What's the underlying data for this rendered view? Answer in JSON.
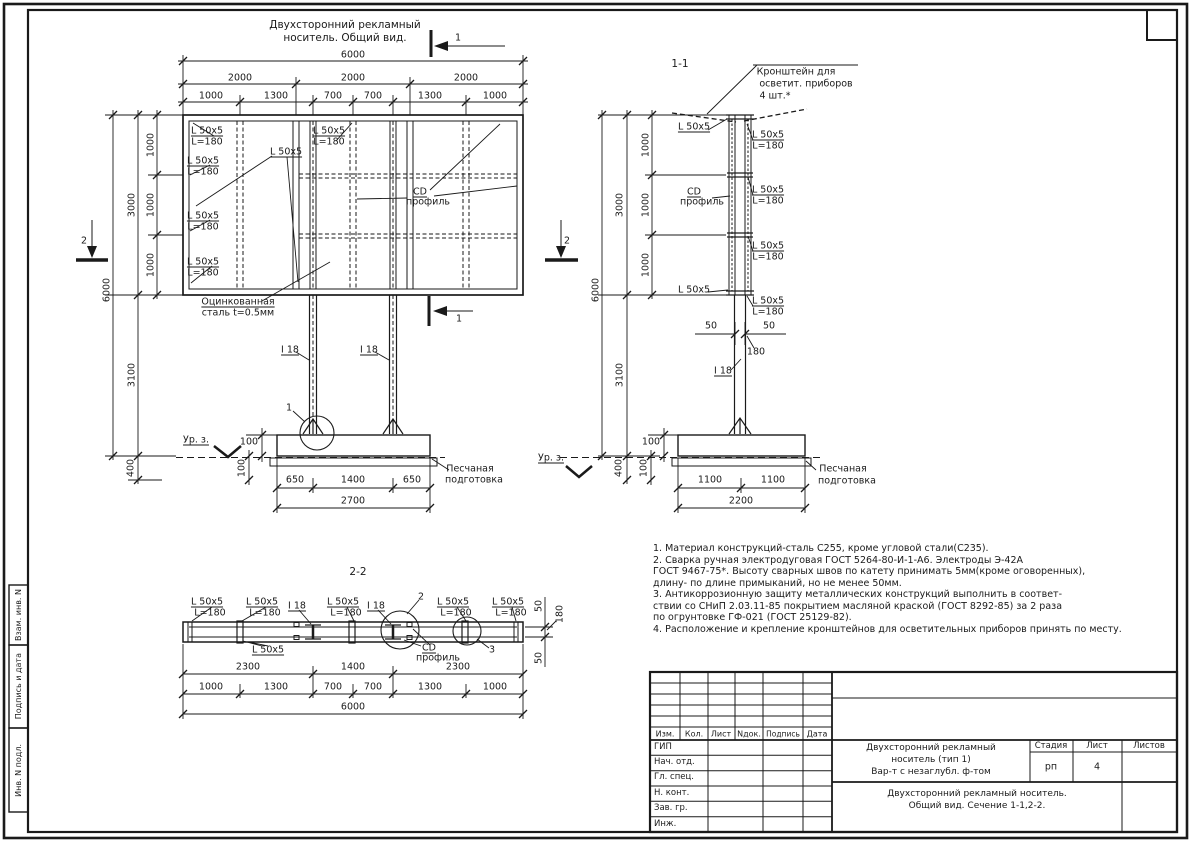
{
  "colors": {
    "line": "#1a1a1a",
    "paper": "#ffffff"
  },
  "side_strip": {
    "boxes": [
      "Взам. инв. N",
      "Подпись и дата",
      "Инв. N подл."
    ]
  },
  "notes": {
    "lines": [
      "1. Материал конструкций-сталь С255, кроме угловой стали(С235).",
      "2. Сварка ручная электродуговая ГОСТ 5264-80-И-1-А6. Электроды Э-42А",
      "ГОСТ 9467-75*. Высоту сварных швов по катету принимать 5мм(кроме оговоренных),",
      "длину- по длине примыканий, но не менее 50мм.",
      "3. Антикоррозионную защиту металлических конструкций выполнить в соответ-",
      "ствии со СНиП 2.03.11-85 покрытием масляной краской (ГОСТ 8292-85) за 2 раза",
      "по огрунтовке ГФ-021 (ГОСТ 25129-82).",
      "4. Расположение и крепление кронштейнов для осветительных приборов принять по месту."
    ]
  },
  "stamp": {
    "rev_cols": [
      "Изм.",
      "Кол.",
      "Лист",
      "Nдок.",
      "Подпись",
      "Дата"
    ],
    "roles": [
      "ГИП",
      "Нач. отд.",
      "Гл. спец.",
      "Н. конт.",
      "Зав. гр.",
      "Инж."
    ],
    "doc_title": [
      "Двухсторонний рекламный",
      "носитель (тип 1)",
      "Вар-т с незаглубл. ф-том"
    ],
    "stage_label": "Стадия",
    "sheet_label": "Лист",
    "sheets_label": "Листов",
    "stage": "рп",
    "sheet": "4",
    "sheets": "",
    "subtitle": [
      "Двухсторонний рекламный носитель.",
      "Общий вид.  Сечение 1-1,2-2."
    ]
  },
  "annotations": [
    {
      "t": "Двухсторонний рекламный",
      "x": 345,
      "y": 25,
      "fs": 10.5,
      "n": "front-view-title"
    },
    {
      "t": "носитель. Общий вид.",
      "x": 345,
      "y": 38,
      "fs": 10.5,
      "n": "front-view-title"
    },
    {
      "t": "1",
      "x": 458,
      "y": 38,
      "n": "section-mark-1-label"
    },
    {
      "t": "6000",
      "x": 353,
      "y": 55
    },
    {
      "t": "2000",
      "x": 240,
      "y": 78
    },
    {
      "t": "2000",
      "x": 353,
      "y": 78
    },
    {
      "t": "2000",
      "x": 466,
      "y": 78
    },
    {
      "t": "1000",
      "x": 211,
      "y": 96
    },
    {
      "t": "1300",
      "x": 276,
      "y": 96
    },
    {
      "t": "700",
      "x": 333,
      "y": 96
    },
    {
      "t": "700",
      "x": 373,
      "y": 96
    },
    {
      "t": "1300",
      "x": 430,
      "y": 96
    },
    {
      "t": "1000",
      "x": 495,
      "y": 96
    },
    {
      "t": "1000",
      "x": 151,
      "y": 145,
      "r": 1
    },
    {
      "t": "1000",
      "x": 151,
      "y": 205,
      "r": 1
    },
    {
      "t": "1000",
      "x": 151,
      "y": 265,
      "r": 1
    },
    {
      "t": "3000",
      "x": 132,
      "y": 205,
      "r": 1
    },
    {
      "t": "6000",
      "x": 107,
      "y": 290,
      "r": 1
    },
    {
      "t": "3100",
      "x": 132,
      "y": 375,
      "r": 1
    },
    {
      "t": "400",
      "x": 131,
      "y": 468,
      "r": 1
    },
    {
      "t": "2",
      "x": 84,
      "y": 241,
      "n": "section-mark-2-label"
    },
    {
      "t": "L 50x5",
      "x": 207,
      "y": 131,
      "u": 1
    },
    {
      "t": "L=180",
      "x": 207,
      "y": 142
    },
    {
      "t": "L 50x5",
      "x": 203,
      "y": 161,
      "u": 1
    },
    {
      "t": "L=180",
      "x": 203,
      "y": 172
    },
    {
      "t": "L 50x5",
      "x": 203,
      "y": 216,
      "u": 1
    },
    {
      "t": "L=180",
      "x": 203,
      "y": 227
    },
    {
      "t": "L 50x5",
      "x": 203,
      "y": 262,
      "u": 1
    },
    {
      "t": "L=180",
      "x": 203,
      "y": 273
    },
    {
      "t": "L 50x5",
      "x": 286,
      "y": 152,
      "u": 1
    },
    {
      "t": "L 50x5",
      "x": 329,
      "y": 131,
      "u": 1
    },
    {
      "t": "L=180",
      "x": 329,
      "y": 142
    },
    {
      "t": "CD",
      "x": 420,
      "y": 192,
      "u": 1
    },
    {
      "t": "профиль",
      "x": 428,
      "y": 202
    },
    {
      "t": "Оцинкованная",
      "x": 238,
      "y": 302,
      "u": 1
    },
    {
      "t": "сталь t=0.5мм",
      "x": 238,
      "y": 313
    },
    {
      "t": "I 18",
      "x": 290,
      "y": 350,
      "u": 1
    },
    {
      "t": "I 18",
      "x": 369,
      "y": 350,
      "u": 1
    },
    {
      "t": "1",
      "x": 289,
      "y": 408,
      "n": "detail-1-label"
    },
    {
      "t": "Ур. з.",
      "x": 196,
      "y": 440,
      "u": 1
    },
    {
      "t": "100",
      "x": 249,
      "y": 442
    },
    {
      "t": "100",
      "x": 242,
      "y": 468,
      "r": 1
    },
    {
      "t": "650",
      "x": 295,
      "y": 480
    },
    {
      "t": "1400",
      "x": 353,
      "y": 480
    },
    {
      "t": "650",
      "x": 412,
      "y": 480
    },
    {
      "t": "2700",
      "x": 353,
      "y": 501
    },
    {
      "t": "Песчаная",
      "x": 470,
      "y": 469
    },
    {
      "t": "подготовка",
      "x": 474,
      "y": 480
    },
    {
      "t": "1",
      "x": 459,
      "y": 319,
      "n": "section-mark-1-label"
    },
    {
      "t": "1-1",
      "x": 680,
      "y": 64,
      "fs": 10.5,
      "n": "section-1-1-title"
    },
    {
      "t": "Кронштейн для",
      "x": 796,
      "y": 72
    },
    {
      "t": "осветит. приборов",
      "x": 806,
      "y": 84
    },
    {
      "t": "4 шт.*",
      "x": 775,
      "y": 96
    },
    {
      "t": "L 50x5",
      "x": 694,
      "y": 127,
      "u": 1
    },
    {
      "t": "L 50x5",
      "x": 768,
      "y": 135,
      "u": 1
    },
    {
      "t": "L=180",
      "x": 768,
      "y": 146
    },
    {
      "t": "CD",
      "x": 694,
      "y": 192,
      "u": 1
    },
    {
      "t": "профиль",
      "x": 702,
      "y": 202
    },
    {
      "t": "L 50x5",
      "x": 768,
      "y": 190,
      "u": 1
    },
    {
      "t": "L=180",
      "x": 768,
      "y": 201
    },
    {
      "t": "L 50x5",
      "x": 768,
      "y": 246,
      "u": 1
    },
    {
      "t": "L=180",
      "x": 768,
      "y": 257
    },
    {
      "t": "L 50x5",
      "x": 694,
      "y": 290,
      "u": 1
    },
    {
      "t": "L 50x5",
      "x": 768,
      "y": 301,
      "u": 1
    },
    {
      "t": "L=180",
      "x": 768,
      "y": 312
    },
    {
      "t": "1000",
      "x": 646,
      "y": 145,
      "r": 1
    },
    {
      "t": "1000",
      "x": 646,
      "y": 205,
      "r": 1
    },
    {
      "t": "1000",
      "x": 646,
      "y": 265,
      "r": 1
    },
    {
      "t": "3000",
      "x": 620,
      "y": 205,
      "r": 1
    },
    {
      "t": "6000",
      "x": 596,
      "y": 290,
      "r": 1
    },
    {
      "t": "3100",
      "x": 620,
      "y": 375,
      "r": 1
    },
    {
      "t": "400",
      "x": 619,
      "y": 468,
      "r": 1
    },
    {
      "t": "2",
      "x": 567,
      "y": 241,
      "n": "section-mark-2-label"
    },
    {
      "t": "50",
      "x": 711,
      "y": 326
    },
    {
      "t": "50",
      "x": 769,
      "y": 326
    },
    {
      "t": "180",
      "x": 756,
      "y": 352
    },
    {
      "t": "I 18",
      "x": 723,
      "y": 371,
      "u": 1
    },
    {
      "t": "Ур. з.",
      "x": 551,
      "y": 458,
      "u": 1
    },
    {
      "t": "100",
      "x": 651,
      "y": 442
    },
    {
      "t": "100",
      "x": 644,
      "y": 468,
      "r": 1
    },
    {
      "t": "1100",
      "x": 710,
      "y": 480
    },
    {
      "t": "1100",
      "x": 773,
      "y": 480
    },
    {
      "t": "2200",
      "x": 741,
      "y": 501
    },
    {
      "t": "Песчаная",
      "x": 843,
      "y": 469
    },
    {
      "t": "подготовка",
      "x": 847,
      "y": 481
    },
    {
      "t": "2-2",
      "x": 358,
      "y": 572,
      "fs": 10.5,
      "n": "section-2-2-title"
    },
    {
      "t": "L 50x5",
      "x": 207,
      "y": 602,
      "u": 1
    },
    {
      "t": "L=180",
      "x": 210,
      "y": 613
    },
    {
      "t": "L 50x5",
      "x": 262,
      "y": 602,
      "u": 1
    },
    {
      "t": "L=180",
      "x": 265,
      "y": 613
    },
    {
      "t": "I 18",
      "x": 297,
      "y": 606,
      "u": 1
    },
    {
      "t": "L 50x5",
      "x": 343,
      "y": 602,
      "u": 1
    },
    {
      "t": "L=180",
      "x": 346,
      "y": 613
    },
    {
      "t": "I 18",
      "x": 376,
      "y": 606,
      "u": 1
    },
    {
      "t": "L 50x5",
      "x": 453,
      "y": 602,
      "u": 1
    },
    {
      "t": "L=180",
      "x": 456,
      "y": 613
    },
    {
      "t": "L 50x5",
      "x": 508,
      "y": 602,
      "u": 1
    },
    {
      "t": "L=180",
      "x": 511,
      "y": 613
    },
    {
      "t": "2",
      "x": 421,
      "y": 597,
      "n": "detail-2-label"
    },
    {
      "t": "3",
      "x": 492,
      "y": 650,
      "n": "detail-3-label"
    },
    {
      "t": "L 50x5",
      "x": 268,
      "y": 650,
      "u": 1
    },
    {
      "t": "CD",
      "x": 429,
      "y": 648,
      "u": 1
    },
    {
      "t": "профиль",
      "x": 438,
      "y": 658
    },
    {
      "t": "50",
      "x": 539,
      "y": 606,
      "r": 1
    },
    {
      "t": "180",
      "x": 560,
      "y": 614,
      "r": 1
    },
    {
      "t": "50",
      "x": 539,
      "y": 658,
      "r": 1
    },
    {
      "t": "2300",
      "x": 248,
      "y": 667
    },
    {
      "t": "1400",
      "x": 353,
      "y": 667
    },
    {
      "t": "2300",
      "x": 458,
      "y": 667
    },
    {
      "t": "1000",
      "x": 211,
      "y": 687
    },
    {
      "t": "1300",
      "x": 276,
      "y": 687
    },
    {
      "t": "700",
      "x": 333,
      "y": 687
    },
    {
      "t": "700",
      "x": 373,
      "y": 687
    },
    {
      "t": "1300",
      "x": 430,
      "y": 687
    },
    {
      "t": "1000",
      "x": 495,
      "y": 687
    },
    {
      "t": "6000",
      "x": 353,
      "y": 707
    }
  ]
}
